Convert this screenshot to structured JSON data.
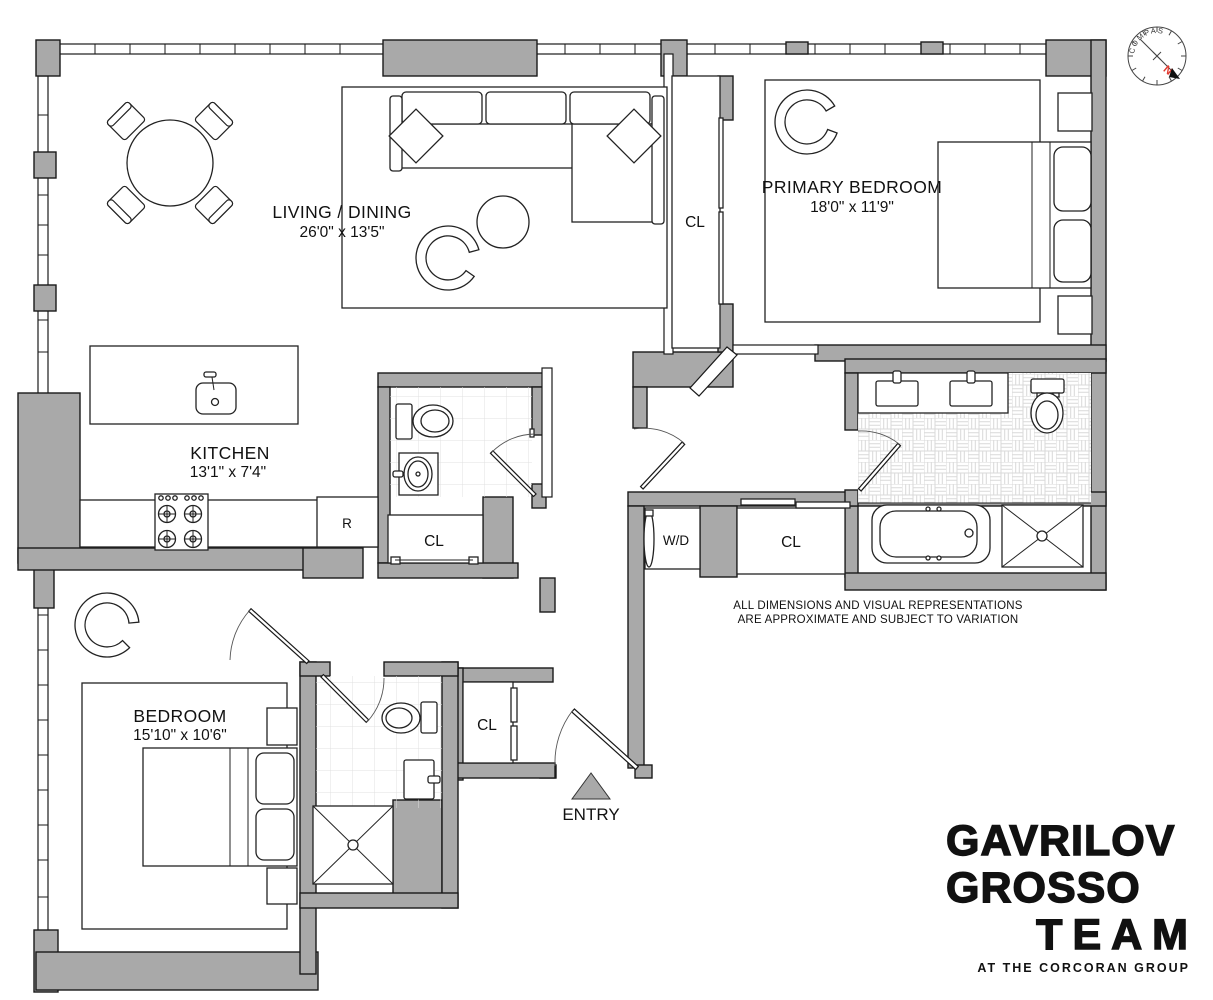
{
  "rooms": {
    "living_dining": {
      "name": "LIVING / DINING",
      "dims": "26'0\" x 13'5\""
    },
    "primary_bedroom": {
      "name": "PRIMARY BEDROOM",
      "dims": "18'0\" x 11'9\""
    },
    "kitchen": {
      "name": "KITCHEN",
      "dims": "13'1\" x 7'4\""
    },
    "bedroom": {
      "name": "BEDROOM",
      "dims": "15'10\" x 10'6\""
    }
  },
  "labels": {
    "closet": "CL",
    "washer_dryer": "W/D",
    "refrigerator": "R",
    "entry": "ENTRY"
  },
  "disclaimer": {
    "line1": "ALL DIMENSIONS AND VISUAL REPRESENTATIONS",
    "line2": "ARE APPROXIMATE AND SUBJECT TO VARIATION"
  },
  "branding": {
    "line1": "GAVRILOV",
    "line2": "GROSSO",
    "line3": "TEAM",
    "tagline": "AT THE CORCORAN GROUP"
  },
  "compass": {
    "label": "COMPASS",
    "north_label": "N"
  },
  "colors": {
    "wall": "#a9a9a9",
    "line": "#1a1a1a",
    "north": "#e03a30",
    "tile_line": "#e0e0e0",
    "basket_line": "#d9d9d9"
  }
}
